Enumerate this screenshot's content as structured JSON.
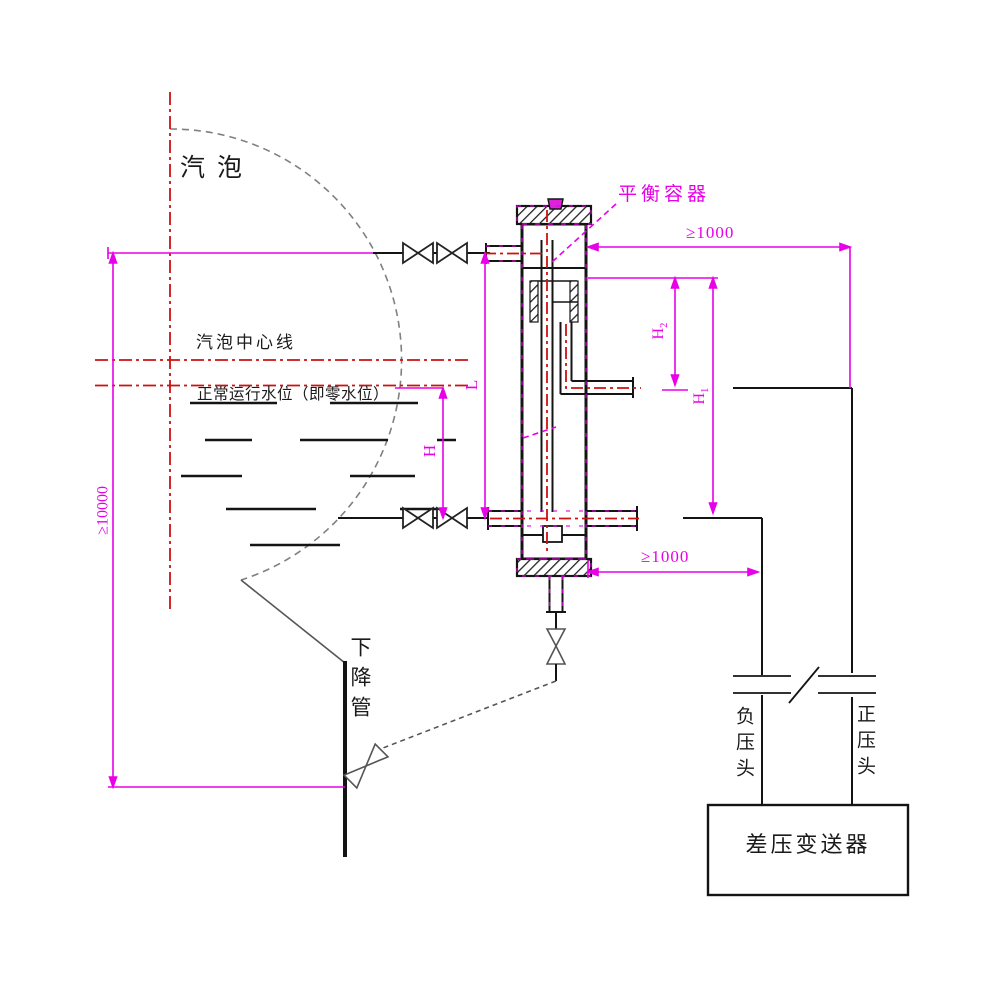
{
  "diagram": {
    "labels": {
      "steam_drum": "汽泡",
      "drum_centerline": "汽泡中心线",
      "normal_water_level": "正常运行水位（即零水位）",
      "balance_vessel": "平衡容器",
      "downcomer": "下降管",
      "negative_pressure_head": "负压头",
      "positive_pressure_head": "正压头",
      "dp_transmitter": "差压变送器"
    },
    "dimensions": {
      "drum_to_downcomer_min": "≥10000",
      "top_right_min": "≥1000",
      "bottom_right_min": "≥1000",
      "L": "L",
      "H": "H",
      "H1_base": "H",
      "H1_sub": "1",
      "H2_base": "H",
      "H2_sub": "2"
    },
    "colors": {
      "dimension_magenta": "#e800e8",
      "centerline_red": "#cc1111",
      "drawing_black": "#141414",
      "drum_outline_gray": "#808080"
    }
  }
}
